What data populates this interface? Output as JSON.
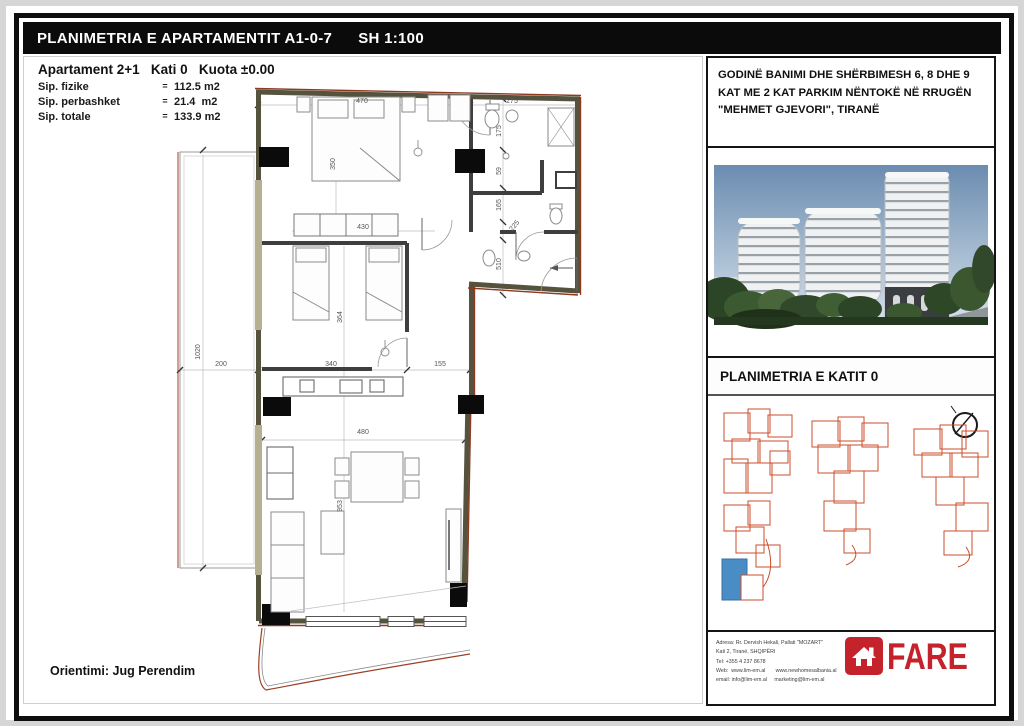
{
  "colors": {
    "frame_black": "#0e0e0e",
    "brand_red": "#c5232b",
    "siteplan_orange": "#cc4e2c",
    "highlight_blue": "#4a8cc4",
    "exterior_wall_red": "#8d3a20"
  },
  "title_bar": {
    "title": "PLANIMETRIA E APARTAMENTIT A1-0-7",
    "scale": "SH 1:100"
  },
  "apartment_info": {
    "heading": "Apartament 2+1   Kati 0   Kuota ±0.00",
    "rows": [
      {
        "label": "Sip. fizike",
        "eq": "=",
        "value": "112.5 m2"
      },
      {
        "label": "Sip. perbashket",
        "eq": "=",
        "value": "21.4  m2"
      },
      {
        "label": "Sip. totale",
        "eq": "=",
        "value": "133.9 m2"
      }
    ],
    "orientation": "Orientimi: Jug Perendim"
  },
  "floor_plan": {
    "dimension_labels": [
      {
        "text": "470",
        "x": 362,
        "y": 103
      },
      {
        "text": "275",
        "x": 512,
        "y": 103
      },
      {
        "text": "175",
        "x": 501,
        "y": 131,
        "rot": -90
      },
      {
        "text": "59",
        "x": 501,
        "y": 171,
        "rot": -90
      },
      {
        "text": "165",
        "x": 501,
        "y": 205,
        "rot": -90
      },
      {
        "text": "225",
        "x": 516,
        "y": 227,
        "rot": -50
      },
      {
        "text": "510",
        "x": 501,
        "y": 264,
        "rot": -90
      },
      {
        "text": "350",
        "x": 335,
        "y": 164,
        "rot": -90
      },
      {
        "text": "430",
        "x": 363,
        "y": 229
      },
      {
        "text": "364",
        "x": 342,
        "y": 317,
        "rot": -90
      },
      {
        "text": "1020",
        "x": 200,
        "y": 352,
        "rot": -90
      },
      {
        "text": "200",
        "x": 221,
        "y": 366
      },
      {
        "text": "340",
        "x": 331,
        "y": 366
      },
      {
        "text": "155",
        "x": 440,
        "y": 366
      },
      {
        "text": "480",
        "x": 363,
        "y": 434
      },
      {
        "text": "953",
        "x": 342,
        "y": 506,
        "rot": -90
      }
    ]
  },
  "right_panel": {
    "project_title": "GODINË BANIMI DHE SHËRBIMESH 6, 8 DHE 9 KAT ME 2 KAT PARKIM NËNTOKË NË RRUGËN \"MEHMET GJEVORI\", TIRANË",
    "floor_title": "PLANIMETRIA E KATIT 0",
    "footer": {
      "address_lines": [
        "Adresa: Rr. Dervish Hekali, Pallati \"MOZART\"",
        "Kati 2, Tiranë, SHQIPËRI",
        "Tel: +355 4 237 8678",
        "Web:  www.lim-em.al       www.newhomesalbania.al",
        "email: info@lim-em.al     marketing@lim-em.al"
      ],
      "logo_text": "FARE"
    }
  }
}
